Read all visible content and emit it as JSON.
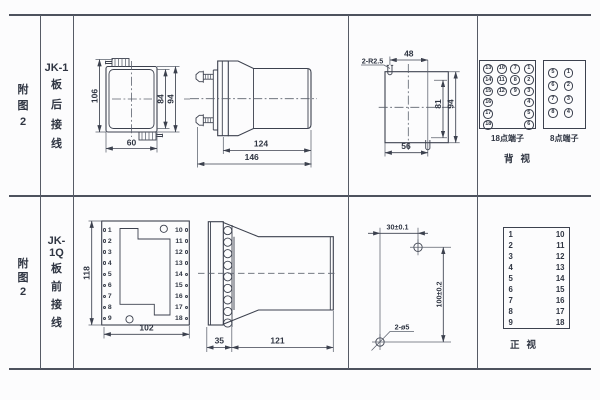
{
  "rows": [
    {
      "fig": [
        "附",
        "图",
        "2"
      ],
      "model": "JK-1",
      "wiring": [
        "板",
        "后",
        "接",
        "线"
      ],
      "rear_view": {
        "h": "106",
        "w": "60",
        "case_h": "84",
        "overall_h": "94"
      },
      "side_view": {
        "depth_body": "124",
        "depth_total": "146"
      },
      "cutout": {
        "slot_label": "2-R2.5",
        "top_w": "48",
        "inner_h": "81",
        "outer_h": "94",
        "bottom_w": "56"
      },
      "t18": {
        "label": "18点端子",
        "cells": [
          "13",
          "10",
          "7",
          "1",
          "14",
          "11",
          "8",
          "2",
          "15",
          "12",
          "9",
          "3",
          "16",
          "",
          "",
          "4",
          "17",
          "",
          "",
          "5",
          "18",
          "",
          "",
          "6"
        ]
      },
      "t8": {
        "label": "8点端子",
        "cells": [
          "5",
          "1",
          "6",
          "2",
          "7",
          "3",
          "8",
          "4"
        ]
      },
      "view_label": "背视"
    },
    {
      "fig": [
        "附",
        "图",
        "2"
      ],
      "model": "JK-1Q",
      "wiring": [
        "板",
        "前",
        "接",
        "线"
      ],
      "front_view": {
        "h": "118",
        "w": "102",
        "left": [
          "1",
          "2",
          "3",
          "4",
          "5",
          "6",
          "7",
          "8",
          "9"
        ],
        "right": [
          "10",
          "11",
          "12",
          "13",
          "14",
          "15",
          "16",
          "17",
          "18"
        ]
      },
      "side_view": {
        "plate_d": "35",
        "body_d": "121"
      },
      "drill": {
        "hole_span_w": "30±0.1",
        "hole_span_h": "100±0.2",
        "hole_label": "2-ø5"
      },
      "front_table": {
        "pairs": [
          {
            "l": "1",
            "r": "10"
          },
          {
            "l": "2",
            "r": "11"
          },
          {
            "l": "3",
            "r": "12"
          },
          {
            "l": "4",
            "r": "13"
          },
          {
            "l": "5",
            "r": "14"
          },
          {
            "l": "6",
            "r": "15"
          },
          {
            "l": "7",
            "r": "16"
          },
          {
            "l": "8",
            "r": "17"
          },
          {
            "l": "9",
            "r": "18"
          }
        ],
        "view_label": "正视"
      }
    }
  ]
}
